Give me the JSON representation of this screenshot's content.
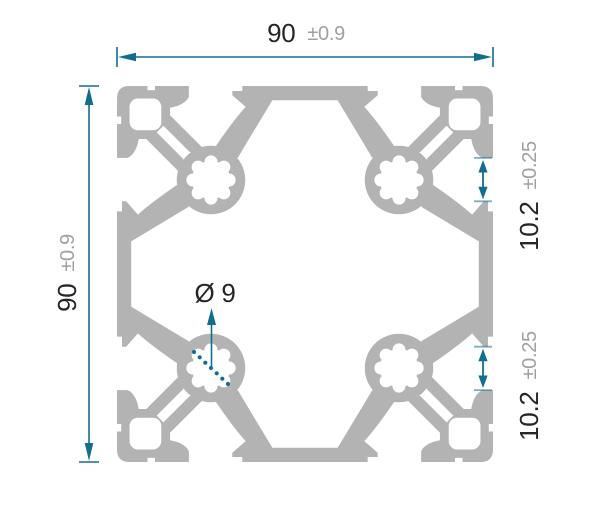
{
  "drawing": {
    "width_dim": {
      "value": "90",
      "tolerance": "±0.9"
    },
    "height_dim": {
      "value": "90",
      "tolerance": "±0.9"
    },
    "slot_dim_top": {
      "value": "10.2",
      "tolerance": "±0.25"
    },
    "slot_dim_bottom": {
      "value": "10.2",
      "tolerance": "±0.25"
    },
    "bore_dim": {
      "value": "Ø 9"
    },
    "colors": {
      "profile_gray": "#b3b3b3",
      "dimension_teal": "#116e93",
      "value_text": "#262626",
      "tolerance_text": "#a0a0a0",
      "background": "#ffffff"
    }
  }
}
